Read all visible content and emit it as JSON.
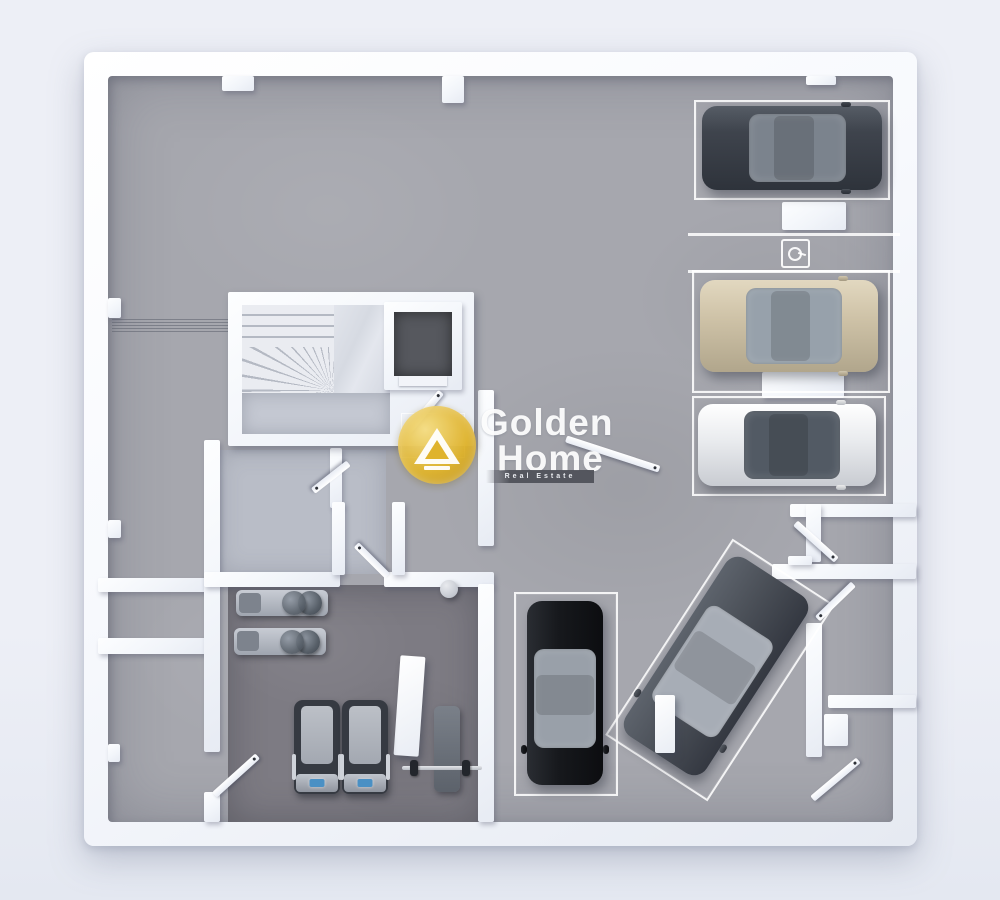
{
  "watermark": {
    "line1": "Golden",
    "line2": "Home",
    "tagline": "Real Estate"
  },
  "palette": {
    "bg": "#edeff6",
    "bg-low": "#e4e8f1",
    "wall": "#f7f9fd",
    "wall-shade": "#e6eaf2",
    "floor": "#a6a7ae",
    "floor-dark": "#7d7b83",
    "room-floor": "#b9bdc7",
    "stair-floor": "#c4c8d2",
    "marble": "#dadde4",
    "elevator-shaft": "#56585e",
    "outline": "#ffffff",
    "gold": "#dfb32c",
    "gold-light": "#f5dd82",
    "tag-bar": "#4e5058",
    "car-suv": "#3f444d",
    "car-suv-glass": "#7b838d",
    "car-beige": "#cfc3a8",
    "car-beige-glass": "#97a1ab",
    "car-white": "#e9ebee",
    "car-white-glass": "#525a64",
    "car-black": "#17191d",
    "car-black-glass": "#99a0a9",
    "car-gray": "#4b5058",
    "car-gray-glass": "#a7adb6",
    "belt": "#bcc0c7",
    "console-blue": "#4a90c4"
  },
  "scene": {
    "type": "3d floor plan render, top-down view",
    "level": "basement parking garage with gym",
    "vehicles": [
      {
        "name": "dark-gray-suv",
        "space": "upper-right space 1"
      },
      {
        "name": "beige-sedan",
        "space": "upper-right space 2"
      },
      {
        "name": "white-sedan",
        "space": "upper-right space 3"
      },
      {
        "name": "black-sedan",
        "space": "lower-center vertical space"
      },
      {
        "name": "gray-sedan",
        "space": "lower-center angled space"
      }
    ],
    "rooms": [
      "open parking area",
      "gym",
      "staircase",
      "elevator",
      "storage rooms",
      "corridor"
    ],
    "gym_equipment": [
      "weight-machine",
      "weight-machine",
      "treadmill",
      "treadmill",
      "flat-bench-with-barbell",
      "exercise-ball"
    ],
    "markings": [
      "white parking space outlines",
      "parking symbol stencil",
      "ramp grating"
    ]
  }
}
